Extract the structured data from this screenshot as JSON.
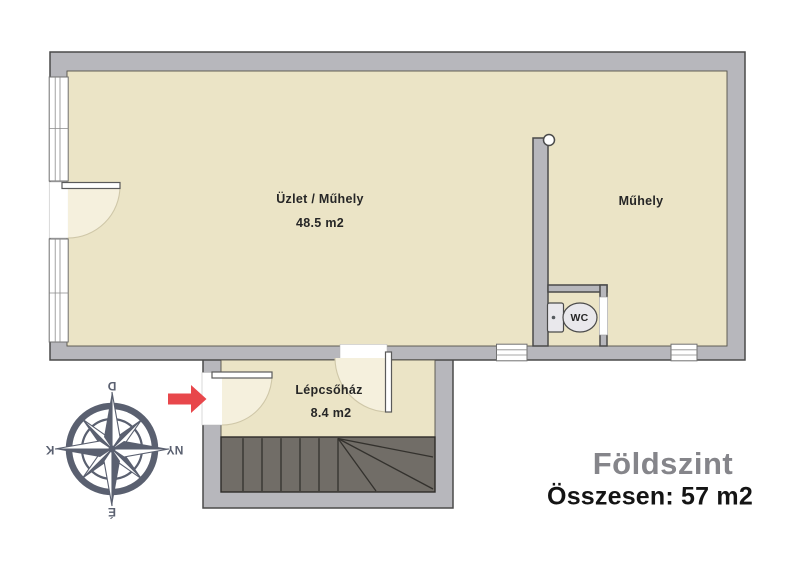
{
  "footer": {
    "floor_name": "Földszint",
    "total": "Összesen: 57 m2"
  },
  "rooms": {
    "uzlet_muhely": {
      "name": "Üzlet / Műhely",
      "area": "48.5 m2"
    },
    "muhely": {
      "name": "Műhely"
    },
    "lepcsohaz": {
      "name": "Lépcsőház",
      "area": "8.4 m2"
    },
    "wc": {
      "name": "WC"
    }
  },
  "compass": {
    "top": "D",
    "right": "NY",
    "bottom": "É",
    "left": "K"
  },
  "colors": {
    "wall": "#b7b7bc",
    "wall-outline": "#4a4a4a",
    "room": "#ebe4c6",
    "swing": "#f5f0dd",
    "swing-line": "#cfc7a8",
    "stairs": "#716d67",
    "stairs-line": "#2e2c29",
    "arrow": "#e8474b",
    "compass": "#5a6070",
    "title-gray": "#85858a",
    "text-dark": "#262626"
  }
}
